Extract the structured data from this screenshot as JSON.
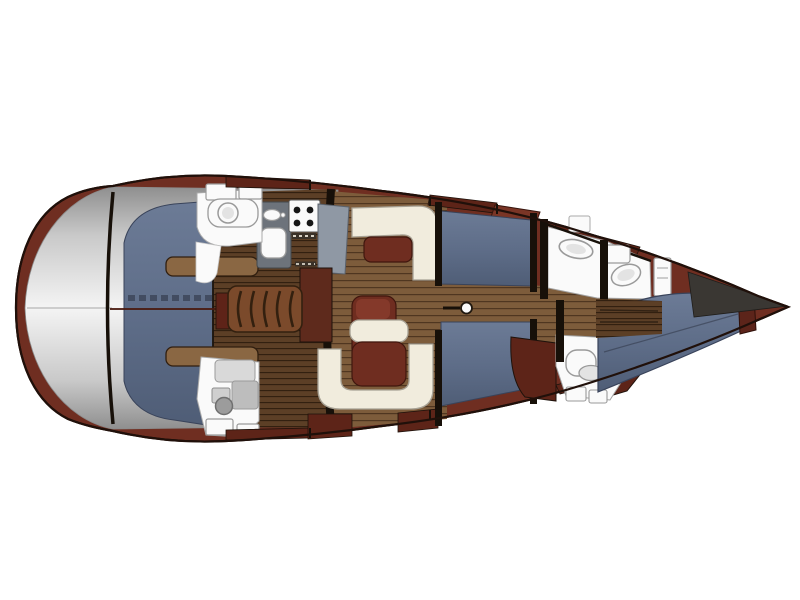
{
  "meta": {
    "description": "Overhead interior layout plan of a sailing yacht",
    "orientation": {
      "bow": "right",
      "stern": "left"
    },
    "canvas": {
      "width": 800,
      "height": 600
    }
  },
  "regions": [
    {
      "id": "stern-platform",
      "label": "stern swim platform"
    },
    {
      "id": "aft-cabin",
      "label": "aft double berth cabin with berth steps"
    },
    {
      "id": "aft-head",
      "label": "aft toilet room with lockers"
    },
    {
      "id": "aft-shower",
      "label": "aft shower room"
    },
    {
      "id": "galley",
      "label": "galley with twin sink, faucet, 4-burner stove and counters"
    },
    {
      "id": "companionway",
      "label": "companionway ladder and wardrobe"
    },
    {
      "id": "saloon",
      "label": "saloon with L-settee, U-settee, tables and nav seat"
    },
    {
      "id": "mast",
      "label": "mast post on centreline"
    },
    {
      "id": "midship-berths",
      "label": "upper and lower midship berths"
    },
    {
      "id": "forward-heads",
      "label": "forward washrooms with sink and toilet"
    },
    {
      "id": "forward-cabin",
      "label": "forward V-berth cabin with headboard"
    },
    {
      "id": "bowsprit",
      "label": "bowsprit"
    }
  ],
  "colors": {
    "background": "#FFFFFF",
    "hull_mahogany": "#6F2E21",
    "hull_outline": "#20100A",
    "mahogany_dark": "#5D2418",
    "mahogany_flap": "#7A3526",
    "trim_notch": "#1E120B",
    "walnut_base": "#5C3F26",
    "walnut_line": "#301E0F",
    "teak_base": "#7D5C3B",
    "teak_line": "#4F3620",
    "tab_wood": "#8A6743",
    "cushion_blue_top": "#6C7B96",
    "cushion_blue_mid": "#5D6C87",
    "cushion_blue_bot": "#4F5D76",
    "cushion_outline": "#39435A",
    "berth_seam": "#2B3140",
    "centerline_red": "#4A1A10",
    "upholstery_cream": "#F1ECDD",
    "upholstery_outline": "#A7A194",
    "table_wood": "#6F2D20",
    "table_outline": "#40170E",
    "chair_highlight": "#84392A",
    "ladder_wood": "#7B4A2B",
    "ladder_line": "#33200F",
    "wardrobe_wood": "#5E2A1C",
    "maroon_panel": "#5E2318",
    "transom_edge": "#8F8F8F",
    "transom_mid": "#C9C9C9",
    "transom_light": "#F4F4F4",
    "counter_dark": "#6D737B",
    "counter_dark_edge": "#43484E",
    "counter_slab": "#8F98A4",
    "counter_slab_edge": "#5B626C",
    "fixture_white": "#FAFAFA",
    "fixture_outline": "#9A9A9A",
    "fixture_inner": "#E3E3E3",
    "burner_black": "#161616",
    "vent_dark": "#3A3128",
    "vent_dash": "#D8D2C6",
    "structure_black": "#171009",
    "shower_panel": "#D9D9D9",
    "shower_tray": "#BDBDBD",
    "shower_knob": "#9C9C9C",
    "shower_knob_edge": "#6F6F6F",
    "bowsprit_gray": "#3A3733",
    "headboard_wood": "#5C241A"
  }
}
